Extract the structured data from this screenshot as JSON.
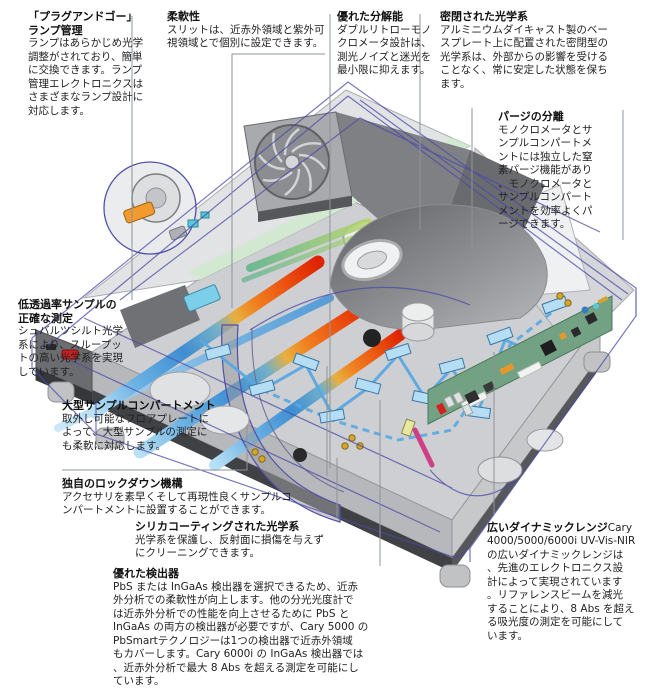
{
  "figure": {
    "subject": "UV-Vis-NIR spectrophotometer cutaway diagram",
    "models_mentioned": "Cary 4000/5000/6000i"
  },
  "palette": {
    "body_gray": "#c9cbce",
    "panel_dark": "#6f7175",
    "wireframe_blue": "#4a4aa8",
    "beam_red": "#de2300",
    "beam_orange": "#f08020",
    "beam_blue": "#3f8ed2",
    "mirror_blue": "#b5def5",
    "pcb_green": "#72a183",
    "lamp_orange": "#f29a2e",
    "power_button_red": "#c92020",
    "green_strip": "#d2e8d0",
    "leader_gray": "#8e9499",
    "text_black": "#1c1c1c"
  },
  "annotations": {
    "plug_and_go": {
      "title": "「プラグアンドゴー」\nランプ管理",
      "body": "ランプはあらかじめ光学\n調整がされており、簡単\nに交換できます。ランプ\n管理エレクトロニクスは\nさまざまなランプ設計に\n対応します。"
    },
    "flexibility": {
      "title": "柔軟性",
      "body": "スリットは、近赤外領域と紫外可\n視領域とで個別に設定できます。"
    },
    "resolution": {
      "title": "優れた分解能",
      "body": "ダブルリトローモノ\nクロメータ設計は、\n測光ノイズと迷光を\n最小限に抑えます。"
    },
    "sealed_optics": {
      "title": "密閉された光学系",
      "body": "アルミニウムダイキャスト製のベー\nスプレート上に配置された密閉型の\n光学系は、外部からの影響を受ける\nことなく、常に安定した状態を保ち\nます。"
    },
    "purge": {
      "title": "パージの分離",
      "body": "モノクロメータとサ\nンプルコンパートメ\nントには独立した窒\n素パージ機能があり\n、モノクロメータと\nサンプルコンパート\nメントを効率よくパ\nージできます。"
    },
    "low_transmission": {
      "title": "低透過率サンプルの\n正確な測定",
      "body": "シュバルツシルト光学\n系により、スループッ\nトの高い光学系を実現\nしています。"
    },
    "large_sample": {
      "title": "大型サンプルコンパートメント",
      "body": "取外し可能なフロアプレートに\nよって、大型サンプルの測定に\nも柔軟に対応します。"
    },
    "lockdown": {
      "title": "独自のロックダウン機構",
      "body": "アクセサリを素早くそして再現性良くサンプルコ\nンパートメントに設置することができます。"
    },
    "silica": {
      "title": "シリカコーティングされた光学系",
      "body": "光学系を保護し、反射面に損傷を与えず\nにクリーニングできます。"
    },
    "detectors": {
      "title": "優れた検出器",
      "body": "PbS または InGaAs 検出器を選択できるため、近赤\n外分析での柔軟性が向上します。他の分光光度計で\nは近赤外分析での性能を向上させるために PbS と\nInGaAs の両方の検出器が必要ですが、Cary 5000 の\nPbSmartテクノロジーは1つの検出器で近赤外領域\nもカバーします。Cary 6000i の InGaAs 検出器では\n、近赤外分析で最大 8 Abs を超える測定を可能にし\nています。"
    },
    "dynamic_range": {
      "title": "広いダイナミックレンジ",
      "title_suffix": "Cary",
      "body": "4000/5000/6000i UV-Vis-NIR\nの広いダイナミックレンジは\n、先進のエレクトロニクス設\n計によって実現されています\n。リファレンスビームを減光\nすることにより、8 Abs を超え\nる吸光度の測定を可能にして\nいます。"
    }
  }
}
